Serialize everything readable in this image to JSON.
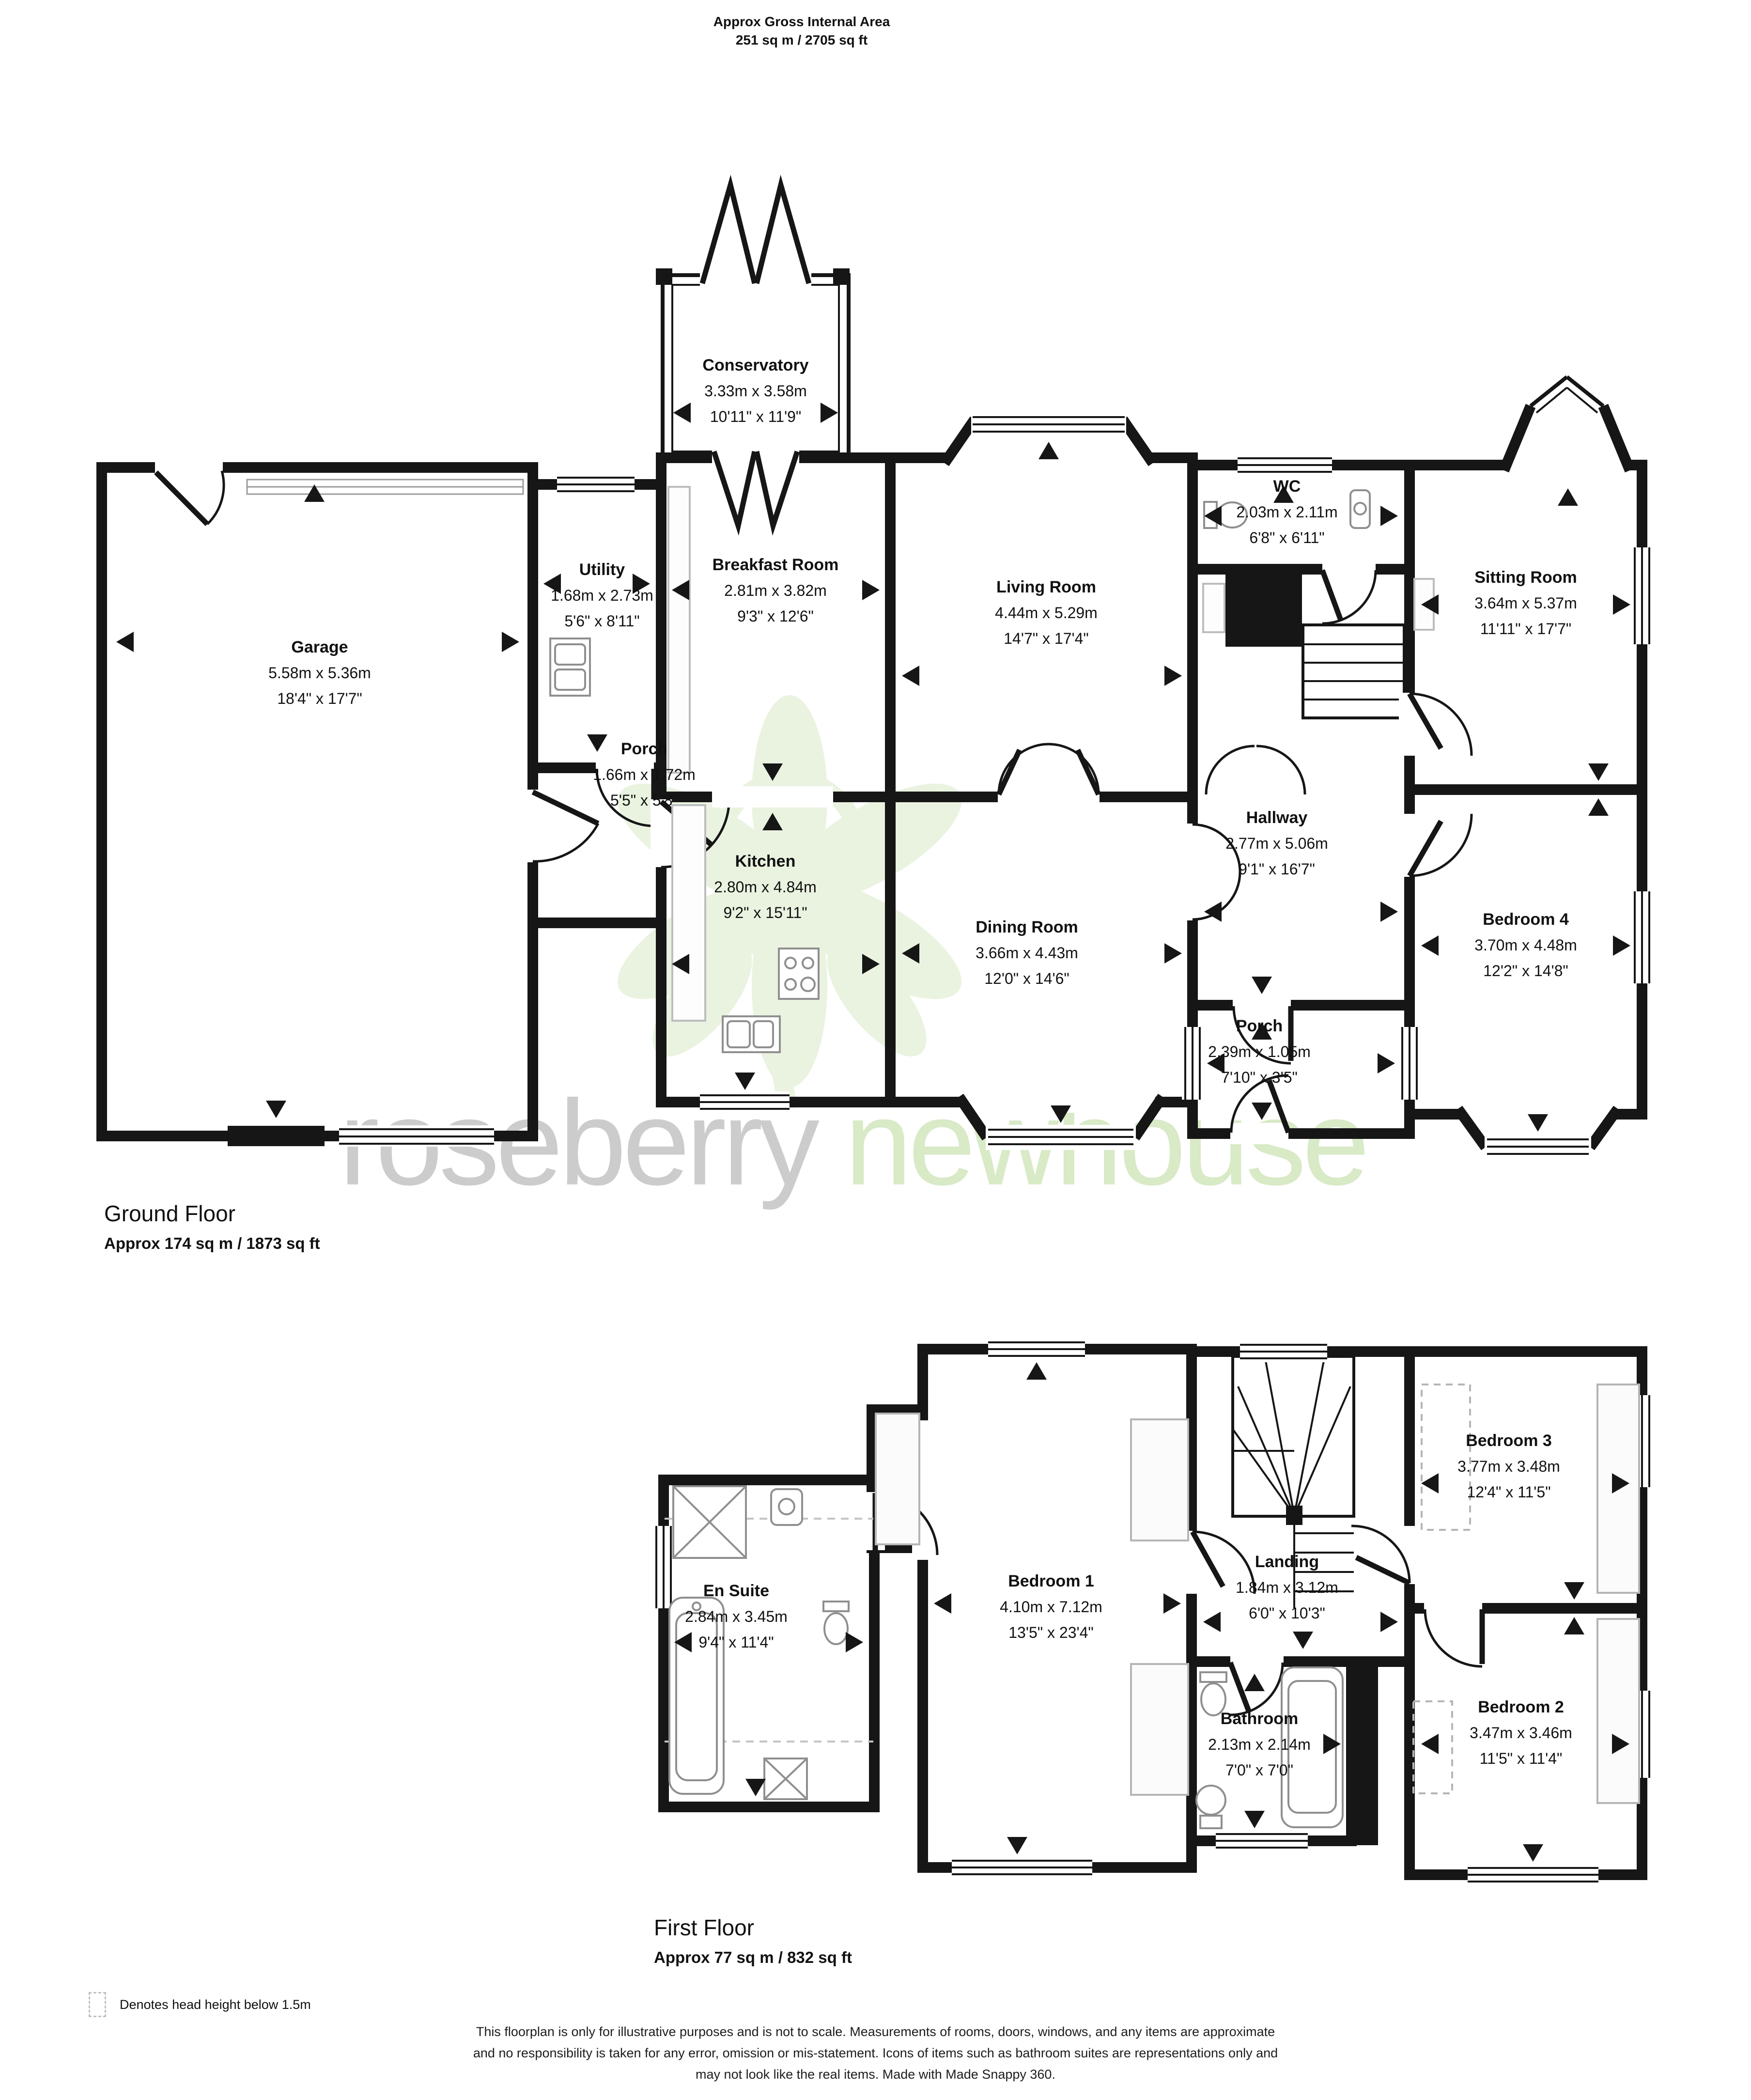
{
  "title": {
    "line1": "Approx Gross Internal Area",
    "line2": "251 sq m / 2705 sq ft"
  },
  "watermark": {
    "brand_word1": "roseberry",
    "brand_word2": "newhouse"
  },
  "floors": {
    "ground": {
      "heading": "Ground Floor",
      "area": "Approx 174 sq m / 1873 sq ft",
      "rooms": {
        "conservatory": {
          "name": "Conservatory",
          "metric": "3.33m x 3.58m",
          "imperial": "10'11\" x 11'9\""
        },
        "garage": {
          "name": "Garage",
          "metric": "5.58m x 5.36m",
          "imperial": "18'4\" x 17'7\""
        },
        "utility": {
          "name": "Utility",
          "metric": "1.68m x 2.73m",
          "imperial": "5'6\" x 8'11\""
        },
        "porch_side": {
          "name": "Porch",
          "metric": "1.66m x 1.72m",
          "imperial": "5'5\" x 5'8\""
        },
        "breakfast_room": {
          "name": "Breakfast Room",
          "metric": "2.81m x 3.82m",
          "imperial": "9'3\" x 12'6\""
        },
        "living_room": {
          "name": "Living Room",
          "metric": "4.44m x 5.29m",
          "imperial": "14'7\" x 17'4\""
        },
        "wc": {
          "name": "WC",
          "metric": "2.03m x 2.11m",
          "imperial": "6'8\" x 6'11\""
        },
        "sitting_room": {
          "name": "Sitting Room",
          "metric": "3.64m x 5.37m",
          "imperial": "11'11\" x 17'7\""
        },
        "kitchen": {
          "name": "Kitchen",
          "metric": "2.80m x 4.84m",
          "imperial": "9'2\" x 15'11\""
        },
        "hallway": {
          "name": "Hallway",
          "metric": "2.77m x 5.06m",
          "imperial": "9'1\" x 16'7\""
        },
        "dining_room": {
          "name": "Dining Room",
          "metric": "3.66m x 4.43m",
          "imperial": "12'0\" x 14'6\""
        },
        "porch_rear": {
          "name": "Porch",
          "metric": "2.39m x 1.05m",
          "imperial": "7'10\" x 3'5\""
        },
        "bedroom4": {
          "name": "Bedroom 4",
          "metric": "3.70m x 4.48m",
          "imperial": "12'2\" x 14'8\""
        }
      }
    },
    "first": {
      "heading": "First Floor",
      "area": "Approx 77 sq m / 832 sq ft",
      "rooms": {
        "en_suite": {
          "name": "En Suite",
          "metric": "2.84m x 3.45m",
          "imperial": "9'4\" x 11'4\""
        },
        "bedroom1": {
          "name": "Bedroom 1",
          "metric": "4.10m x 7.12m",
          "imperial": "13'5\" x 23'4\""
        },
        "landing": {
          "name": "Landing",
          "metric": "1.84m x 3.12m",
          "imperial": "6'0\" x 10'3\""
        },
        "bedroom3": {
          "name": "Bedroom 3",
          "metric": "3.77m x 3.48m",
          "imperial": "12'4\" x 11'5\""
        },
        "bathroom": {
          "name": "Bathroom",
          "metric": "2.13m x 2.14m",
          "imperial": "7'0\" x 7'0\""
        },
        "bedroom2": {
          "name": "Bedroom 2",
          "metric": "3.47m x 3.46m",
          "imperial": "11'5\" x 11'4\""
        }
      }
    }
  },
  "legend": {
    "label": "Denotes head height below 1.5m"
  },
  "footer": {
    "line1": "This floorplan is only for illustrative purposes and is not to scale. Measurements of rooms, doors, windows, and any items are approximate",
    "line2": "and no responsibility is taken for any error, omission or mis-statement. Icons of items such as bathroom suites are representations only and",
    "line3": "may not look like the real items. Made with Made Snappy 360."
  },
  "colors": {
    "wall": "#161616",
    "fixture_outline": "#8f8f8f",
    "watermark_gray": "#cccccc",
    "watermark_green": "#d8eac6",
    "leaf_watermark": "#eaf3e0"
  }
}
